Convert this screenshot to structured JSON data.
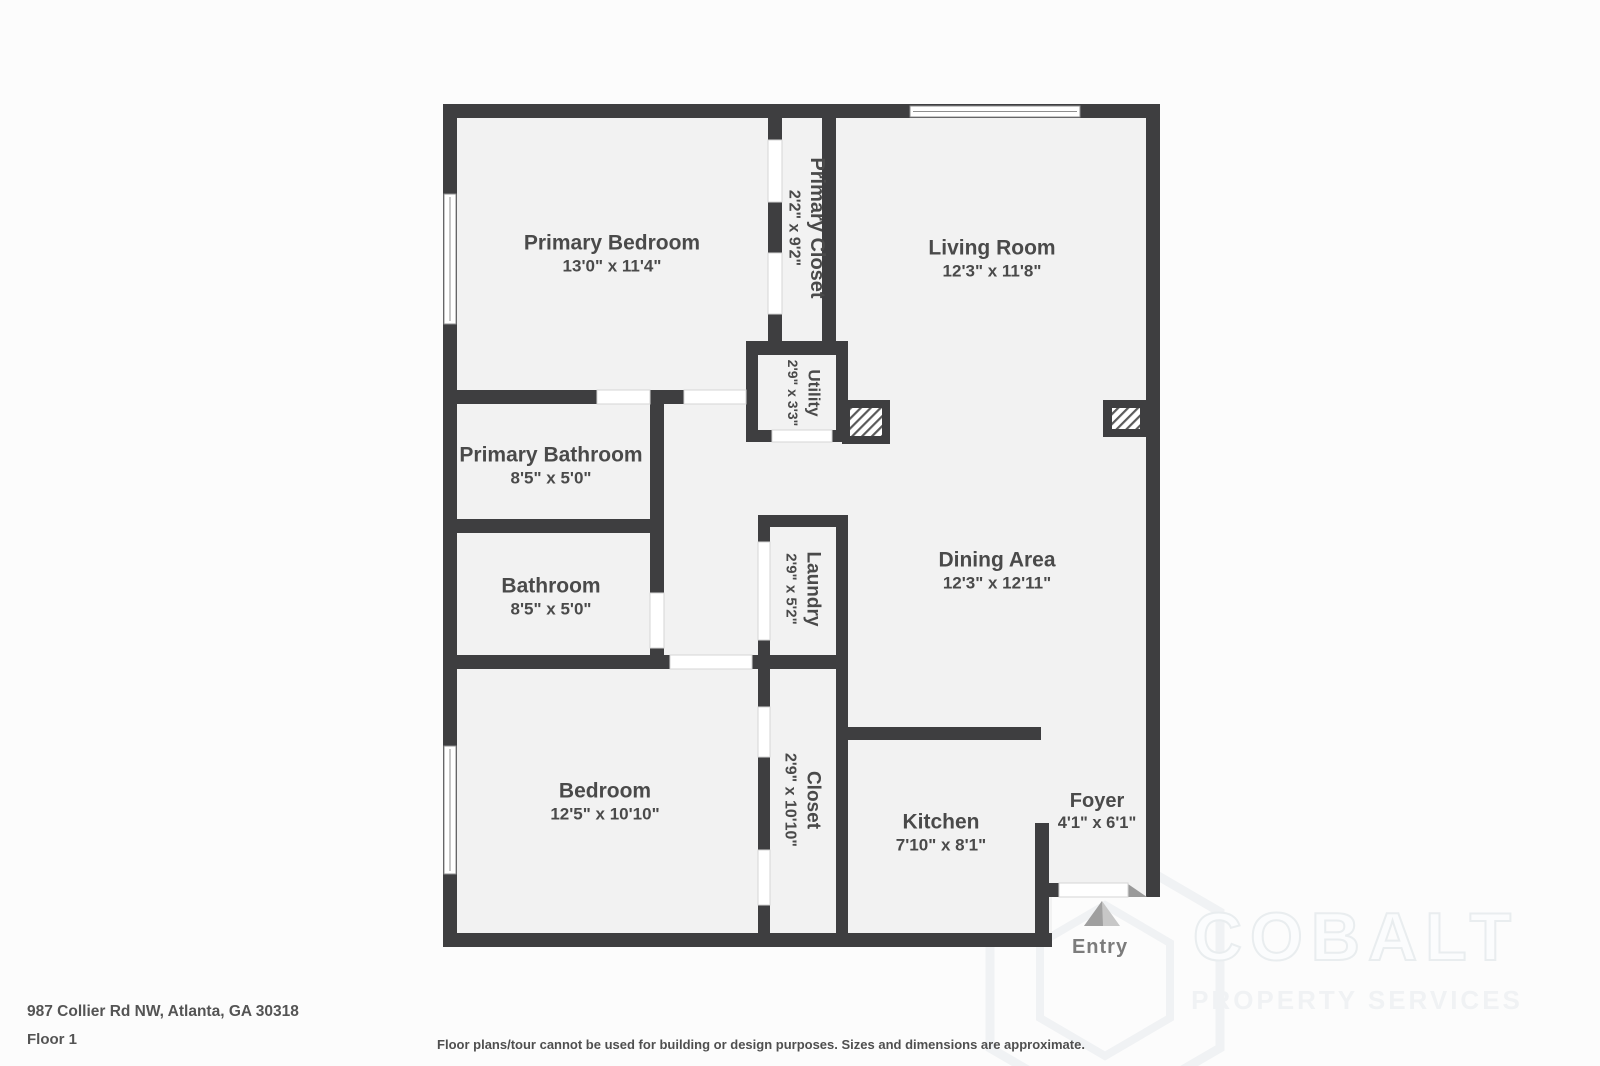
{
  "colors": {
    "wall": "#3e3e40",
    "room_fill": "#f2f2f2",
    "label_text": "#4a4a4a",
    "entry_text": "#7c7c7c",
    "watermark": "#f0f2f4"
  },
  "floorplan": {
    "rooms": [
      {
        "id": "primary-bedroom",
        "name": "Primary Bedroom",
        "dims": "13'0\" x 11'4\""
      },
      {
        "id": "primary-closet",
        "name": "Primary Closet",
        "dims": "2'2\" x 9'2\"",
        "orientation": "vertical"
      },
      {
        "id": "living-room",
        "name": "Living Room",
        "dims": "12'3\" x 11'8\""
      },
      {
        "id": "utility",
        "name": "Utility",
        "dims": "2'9\" x 3'3\"",
        "orientation": "vertical"
      },
      {
        "id": "primary-bathroom",
        "name": "Primary Bathroom",
        "dims": "8'5\" x 5'0\""
      },
      {
        "id": "bathroom",
        "name": "Bathroom",
        "dims": "8'5\" x 5'0\""
      },
      {
        "id": "laundry",
        "name": "Laundry",
        "dims": "2'9\" x 5'2\"",
        "orientation": "vertical"
      },
      {
        "id": "dining-area",
        "name": "Dining Area",
        "dims": "12'3\" x 12'11\""
      },
      {
        "id": "bedroom",
        "name": "Bedroom",
        "dims": "12'5\" x 10'10\""
      },
      {
        "id": "closet",
        "name": "Closet",
        "dims": "2'9\" x 10'10\"",
        "orientation": "vertical"
      },
      {
        "id": "kitchen",
        "name": "Kitchen",
        "dims": "7'10\" x 8'1\""
      },
      {
        "id": "foyer",
        "name": "Foyer",
        "dims": "4'1\" x 6'1\""
      }
    ],
    "entry_label": "Entry"
  },
  "footer": {
    "address": "987 Collier Rd NW, Atlanta, GA 30318",
    "floor": "Floor 1",
    "disclaimer": "Floor plans/tour cannot be used for building or design purposes. Sizes and dimensions are approximate."
  },
  "watermark": {
    "brand": "COBALT",
    "tagline": "PROPERTY SERVICES"
  }
}
